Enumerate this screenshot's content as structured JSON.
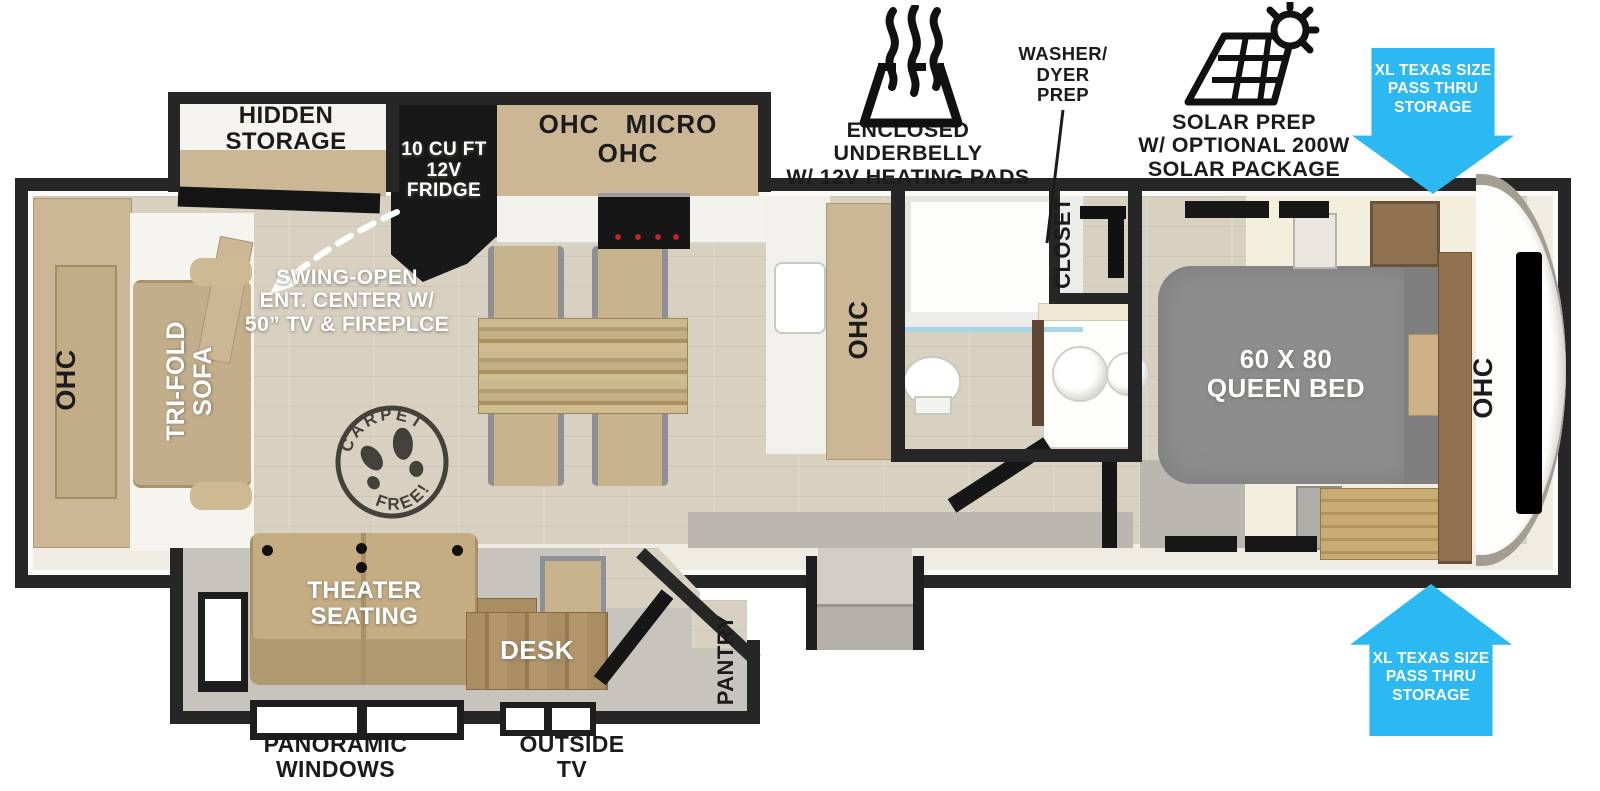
{
  "labels": {
    "hidden_storage": "HIDDEN\nSTORAGE",
    "fridge": "10 CU FT\n12V\nFRIDGE",
    "kitchen_cabinets": "OHC  MICRO  OHC",
    "swing_open": "SWING-OPEN\nENT. CENTER W/\n50” TV & FIREPLCE",
    "rear_cabinet": "OHC",
    "sofa": "TRI-FOLD\nSOFA",
    "sink_cabinet": "OHC",
    "closet": "CLOSET",
    "queen_bed": "60 X 80\nQUEEN BED",
    "bedroom_cabinet": "OHC",
    "theater_seating": "THEATER\nSEATING",
    "desk": "DESK",
    "pantry": "PANTRY",
    "panoramic_windows": "PANORAMIC\nWINDOWS",
    "outside_tv": "OUTSIDE\nTV"
  },
  "features": {
    "underbelly": "ENCLOSED UNDERBELLY\nW/ 12V HEATING PADS",
    "washer_dryer": "WASHER/\nDYER\nPREP",
    "solar": "SOLAR PREP\nW/ OPTIONAL 200W\nSOLAR PACKAGE"
  },
  "storage_arrows": {
    "top": "XL TEXAS SIZE\nPASS THRU\nSTORAGE",
    "bottom": "XL TEXAS SIZE\nPASS THRU\nSTORAGE"
  },
  "badge": {
    "carpet": "CARPET",
    "free": "FREE!"
  },
  "colors": {
    "arrow_blue": "#2cb9f1",
    "wall": "#262626",
    "cabinet_tan": "#cbb795",
    "bed_gray": "#8d8d8d",
    "floor_wood": "#d8d1c2"
  }
}
